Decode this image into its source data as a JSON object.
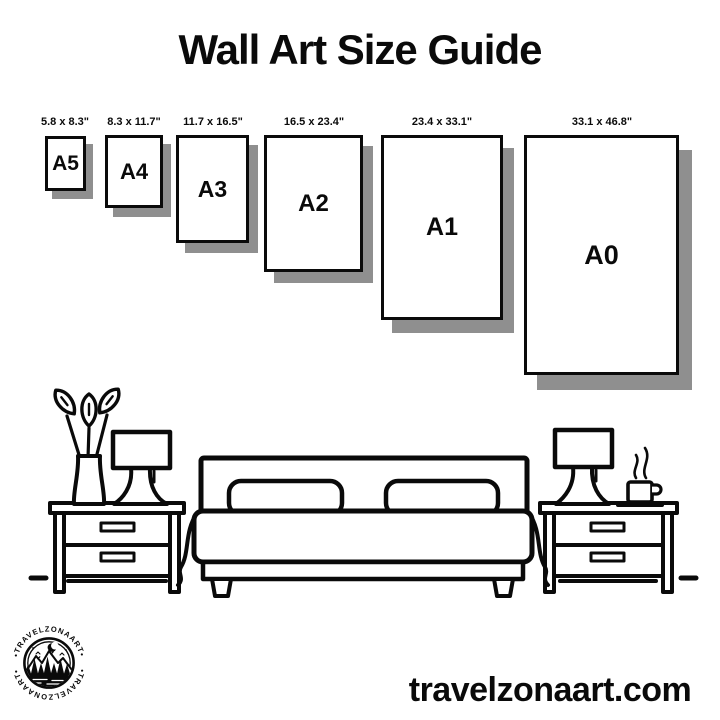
{
  "title": "Wall Art Size Guide",
  "sizes": [
    {
      "name": "A5",
      "dimensions": "5.8 x 8.3\""
    },
    {
      "name": "A4",
      "dimensions": "8.3 x 11.7\""
    },
    {
      "name": "A3",
      "dimensions": "11.7 x 16.5\""
    },
    {
      "name": "A2",
      "dimensions": "16.5 x 23.4\""
    },
    {
      "name": "A1",
      "dimensions": "23.4 x 33.1\""
    },
    {
      "name": "A0",
      "dimensions": "33.1 x 46.8\""
    }
  ],
  "logo": {
    "arc_text_top": "•TRAVELZONAART•",
    "arc_text_bottom": "•TRAVELZONAART•"
  },
  "website": "travelzonaart.com",
  "colors": {
    "background": "#ffffff",
    "ink": "#0a0a0a",
    "frame_shadow": "#8f8f8f"
  },
  "illustration": {
    "items": [
      "flower-vase",
      "table-lamp-left",
      "nightstand-left",
      "double-bed",
      "nightstand-right",
      "table-lamp-right",
      "coffee-cup"
    ]
  }
}
